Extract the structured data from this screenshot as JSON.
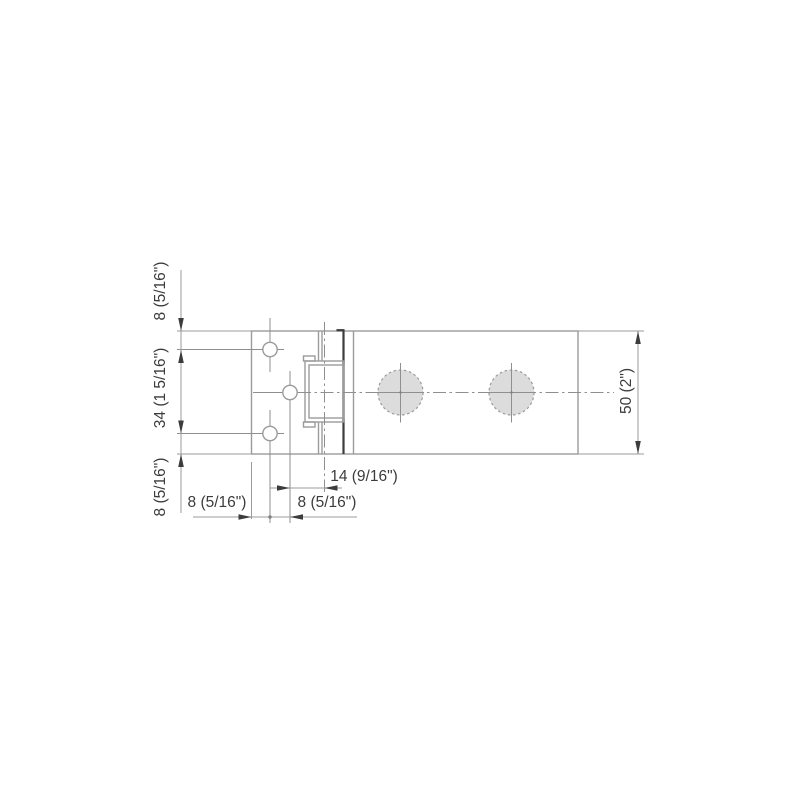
{
  "drawing": {
    "title": "technical-dimension-drawing",
    "units": "mm (inches)",
    "colors": {
      "line": "#9b9b9b",
      "dark_line": "#3c3c3c",
      "centerline": "#8f8f8f",
      "text": "#3c3c3c",
      "bore_fill": "#dcdcdc",
      "background": "#ffffff"
    },
    "labels": {
      "top_edge_to_hole": "8 (5/16\")",
      "hole_spacing_vertical": "34 (1 5/16\")",
      "bottom_edge_to_hole": "8 (5/16\")",
      "body_height": "50 (2\")",
      "hole_to_centerline_horiz": "14 (9/16\")",
      "left_edge_to_hole": "8 (5/16\")",
      "hole_to_slot_center": "8 (5/16\")"
    }
  }
}
